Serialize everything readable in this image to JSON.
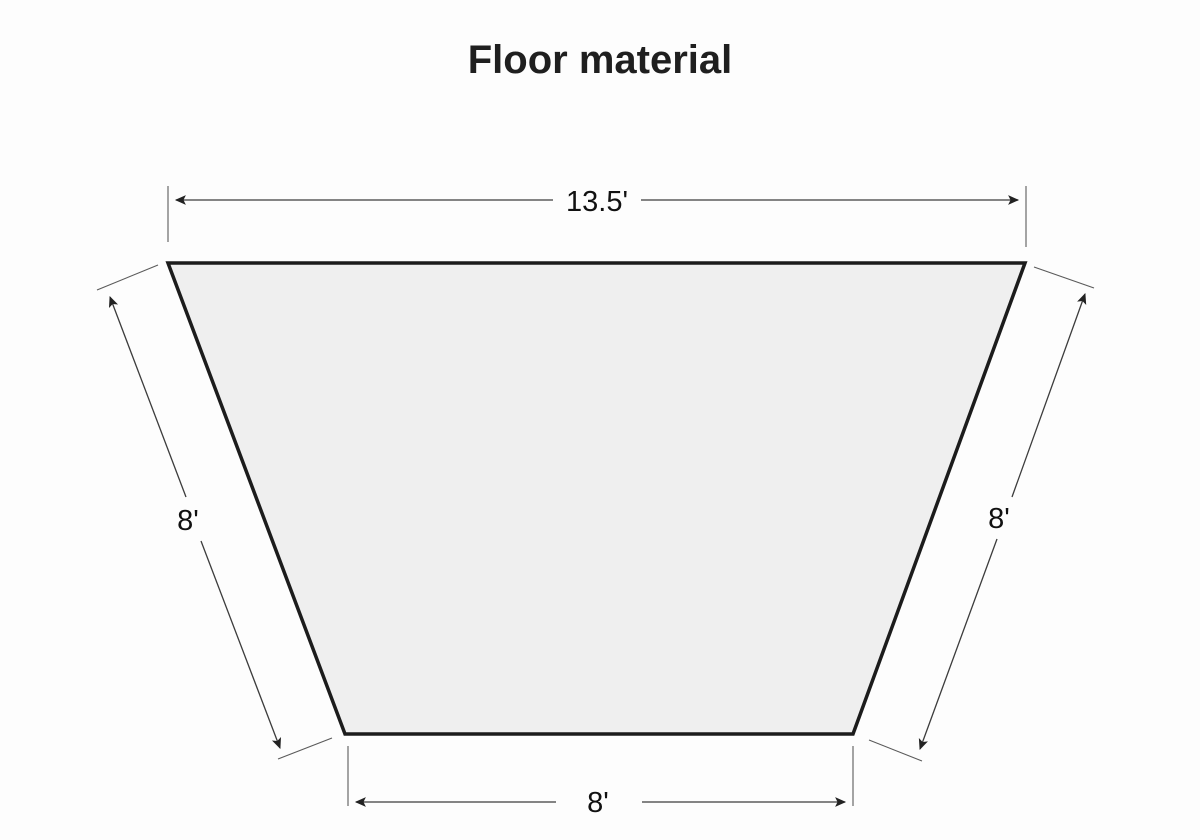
{
  "page": {
    "title": "Floor material",
    "background_color": "#fdfdfd"
  },
  "diagram": {
    "shape": "trapezoid",
    "description": "Trapezoidal floor plan with dimension arrows on all four sides",
    "fill_color": "#efefef",
    "outline_color": "#1c1c1c",
    "dimension_line_color": "#3c3c3c",
    "dimensions": {
      "top": {
        "label": "13.5'",
        "value_feet": 13.5
      },
      "bottom": {
        "label": "8'",
        "value_feet": 8
      },
      "left": {
        "label": "8'",
        "value_feet": 8
      },
      "right": {
        "label": "8'",
        "value_feet": 8
      }
    }
  }
}
